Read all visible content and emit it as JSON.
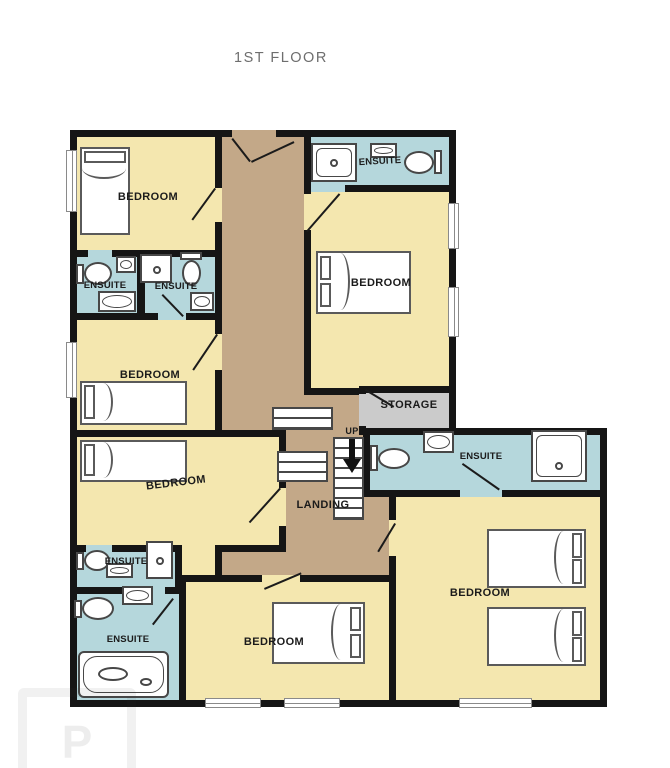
{
  "title": "1ST FLOOR",
  "colors": {
    "bedroom_floor": "#f4e7af",
    "ensuite_floor": "#b5d7dc",
    "corridor_floor": "#c3a888",
    "storage_floor": "#cbcbcb",
    "wall": "#151515",
    "fixture_outline": "#474747",
    "title_text": "#6e6e6e",
    "label_text": "#1b1b1b"
  },
  "rooms": [
    {
      "name": "bedroom-top-left",
      "label": "BEDROOM"
    },
    {
      "name": "ensuite-left-a",
      "label": "ENSUITE"
    },
    {
      "name": "ensuite-left-b",
      "label": "ENSUITE"
    },
    {
      "name": "bedroom-left-mid",
      "label": "BEDROOM"
    },
    {
      "name": "bedroom-left-lower",
      "label": "BEDROOM"
    },
    {
      "name": "ensuite-bottom-a",
      "label": "ENSUITE"
    },
    {
      "name": "ensuite-bottom-b",
      "label": "ENSUITE"
    },
    {
      "name": "bedroom-bottom-center",
      "label": "BEDROOM"
    },
    {
      "name": "bedroom-bottom-right",
      "label": "BEDROOM"
    },
    {
      "name": "ensuite-top-right",
      "label": "ENSUITE"
    },
    {
      "name": "bedroom-top-right",
      "label": "BEDROOM"
    },
    {
      "name": "storage",
      "label": "STORAGE"
    },
    {
      "name": "ensuite-right-mid",
      "label": "ENSUITE"
    },
    {
      "name": "landing",
      "label": "LANDING"
    },
    {
      "name": "stairs-direction",
      "label": "UP"
    }
  ],
  "watermark": {
    "letter": "P"
  }
}
